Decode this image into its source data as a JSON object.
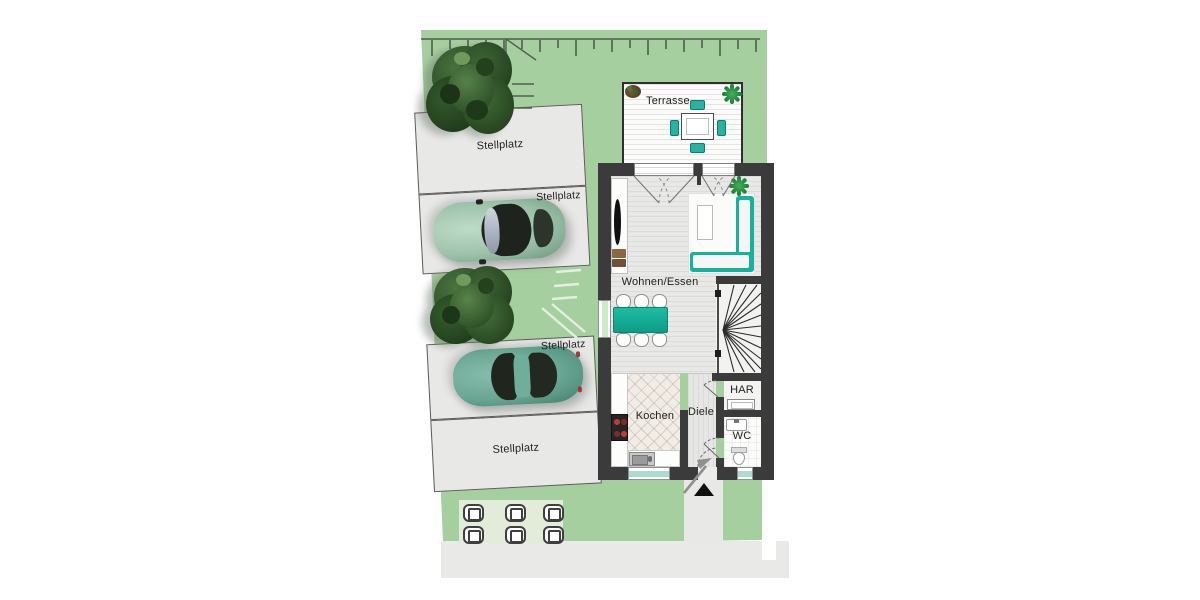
{
  "floor_plan": {
    "outdoor": {
      "terrace_label": "Terrasse",
      "parking_labels": [
        "Stellplatz",
        "Stellplatz",
        "Stellplatz",
        "Stellplatz"
      ]
    },
    "rooms": {
      "living": {
        "label": "Wohnen/Essen"
      },
      "kitchen": {
        "label": "Kochen"
      },
      "hall": {
        "label": "Diele"
      },
      "utility": {
        "label": "HAR"
      },
      "wc": {
        "label": "WC"
      }
    },
    "colors": {
      "grass": "#a6cf9f",
      "wall": "#3b3b3b",
      "accent_teal": "#16b29c",
      "stall_gray": "#e8e8e7",
      "paving_gray": "#e9e9e8"
    }
  }
}
